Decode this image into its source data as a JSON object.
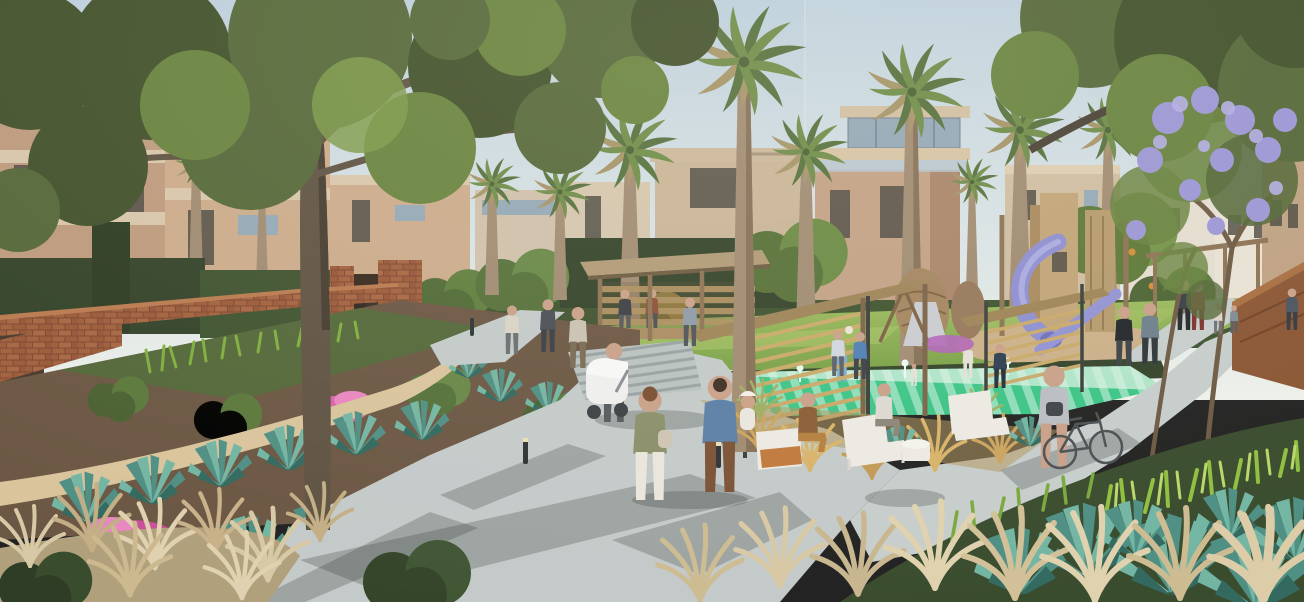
{
  "window": {
    "title": "Residential community park - architectural rendering"
  },
  "scene": {
    "type": "photorealistic architectural rendering",
    "setting": "Linear community park between modern villas: promenade with strolling residents, terraced agave gardens, timber pavilion, green splash pad, timber playground with purple tube slides, palms and a flowering jacaranda",
    "time_of_day": "late-afternoon sunlight",
    "counts": {
      "palm_trees": 11,
      "people_approx": 38,
      "lounge_chairs": 3,
      "play_towers": 2,
      "bollard_lights": 4
    },
    "elements": {
      "sky": "clear pale sky",
      "buildings_left": "terracotta townhomes with hedges and brick garden walls",
      "buildings_center": "beige modern villas with roof terraces and glass railings",
      "buildings_right": "cream villas behind a purple-flowering jacaranda",
      "shade_tree_left": "large dark-canopy shade tree over the terraces",
      "garden": "terraced beds with rows of teal agave, pink flowers and golden grasses",
      "main_path": "concrete promenade with dappled tree shadows",
      "sand_trail": "decomposed-granite garden trail",
      "pavilion": "flat-roof timber shade pavilion with visitors",
      "lawn": "event lawn with children playing",
      "splash_pad": "green striped splash pad",
      "screens": "sloped timber slat screens on steel posts",
      "playground": "timber play towers, purple tube slides, woven nest pods, metal slide",
      "corten_wall": "weathered-steel planter wall at right",
      "people": "couple walking with a child, woman pushing a white stroller, woman walking a bicycle, loungers on white chairs, kids on the lawn"
    },
    "palette": {
      "sky_top": "#bccfdd",
      "sky_mid": "#dde6e6",
      "sky_horizon": "#eef0ea",
      "building_tan": "#c2a185",
      "building_light": "#d8c6ab",
      "canopy_dark": "#42512c",
      "canopy_mid": "#5e7638",
      "canopy_light": "#7d9a4a",
      "jacaranda_purple": "#9c96d6",
      "palm_trunk": "#a08b72",
      "lawn_green": "#8fae52",
      "splash_teal": "#3cc487",
      "splash_stripe": "rgba(255,255,255,0.42)",
      "path_concrete": "#c3cac9",
      "path_shadow": "rgba(54,64,60,0.27)",
      "sand_path": "#d9c49c",
      "brick": "#9e5d3b",
      "agave_teal": "#55938a",
      "grass_gold": "#c9b28a",
      "slide_purple": "#8d8ed1",
      "timber": "#ab8d64",
      "corten_rust": "#8a5634",
      "chair_white": "#eceae3",
      "flower_pink": "#d864a8"
    }
  }
}
